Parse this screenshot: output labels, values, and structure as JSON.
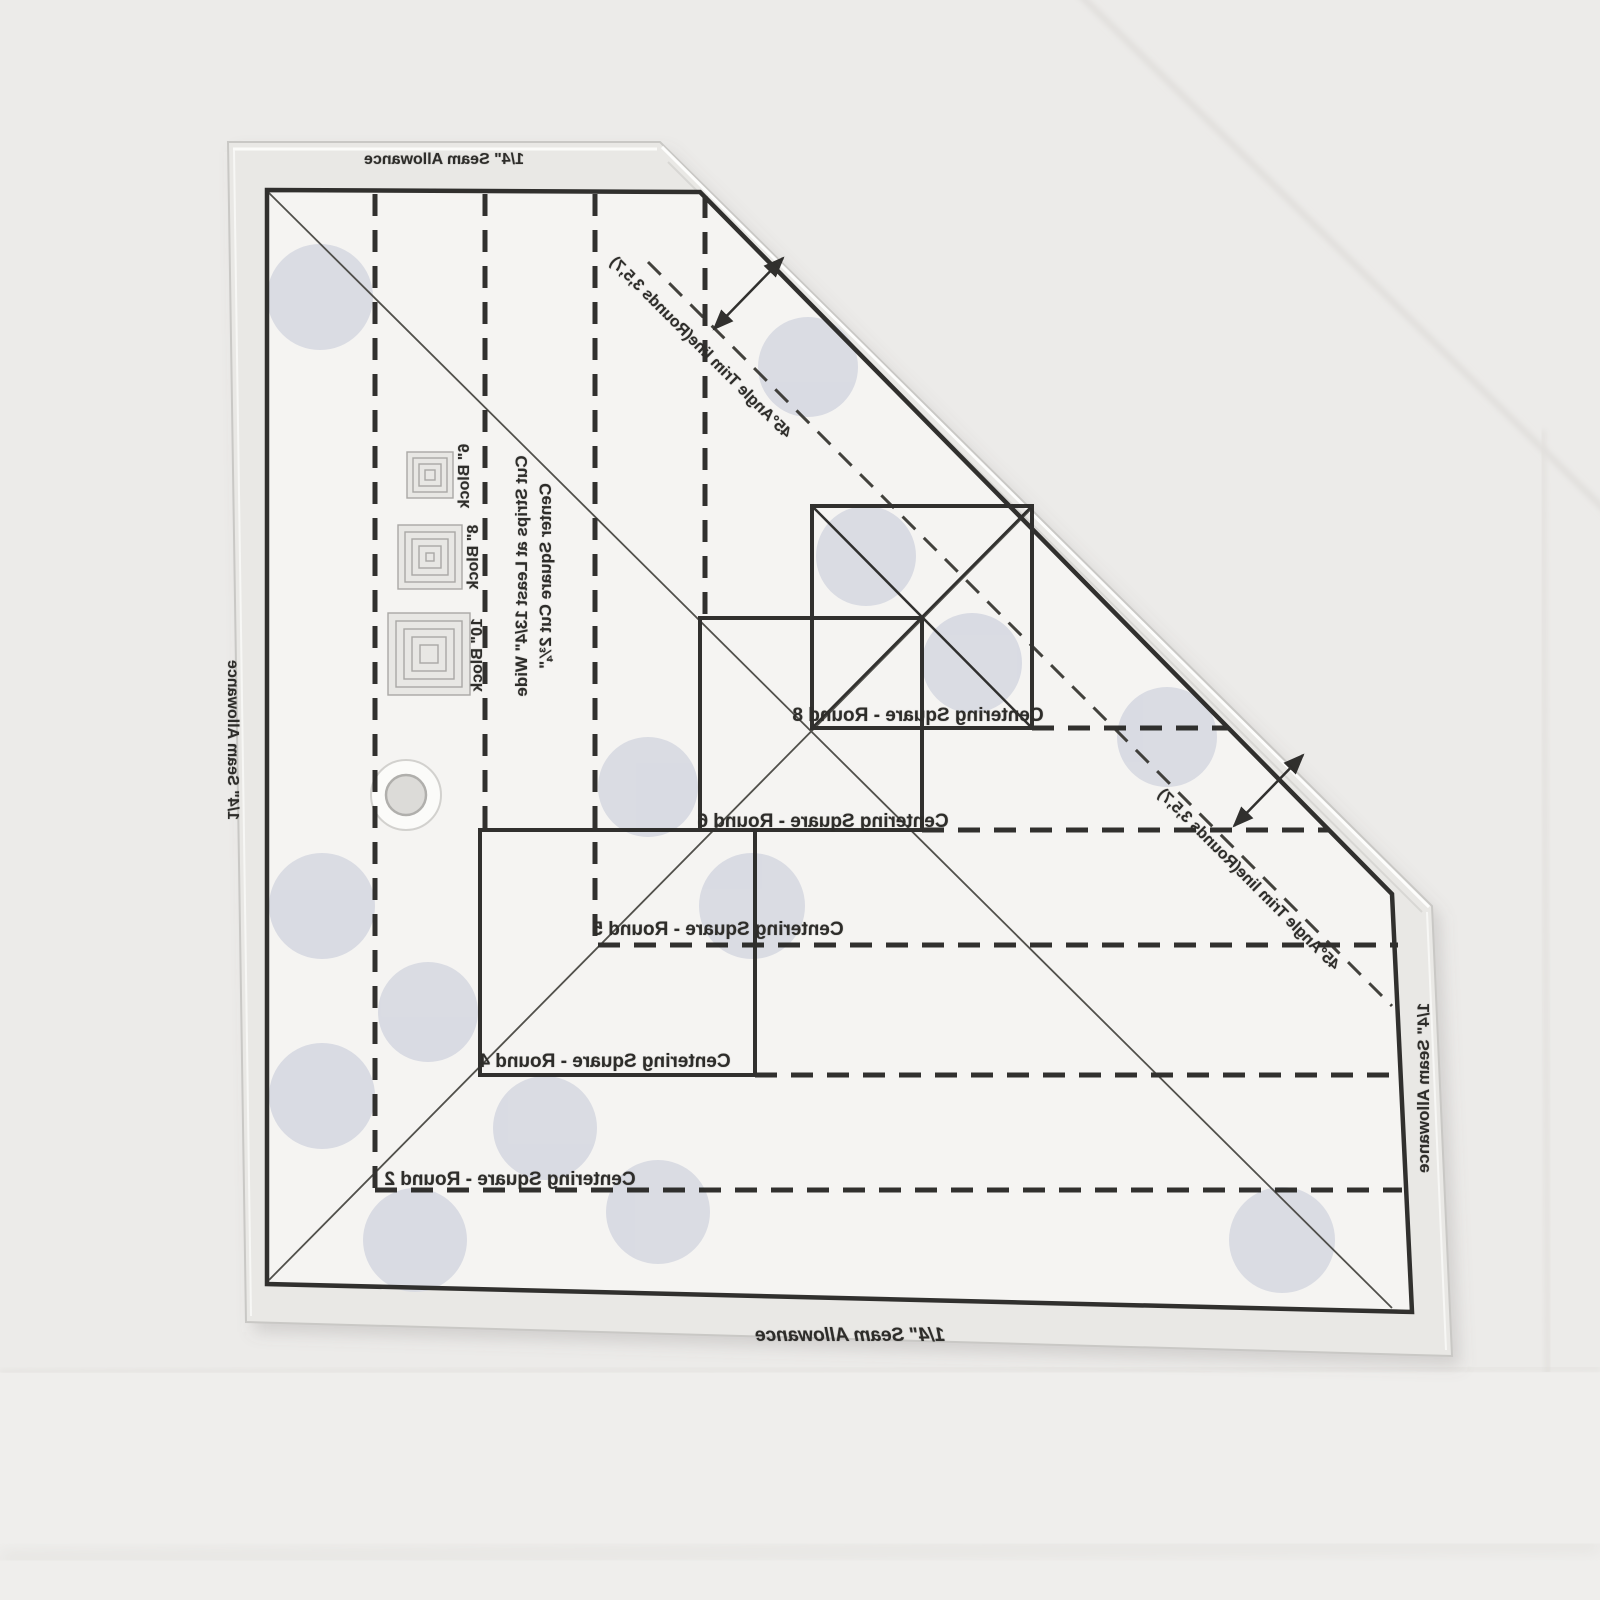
{
  "ruler": {
    "type_note": "transparent log cabin quilting trim ruler, photographed face-down (printing mirrored)",
    "seam_allowance": {
      "top": "1/4\" Seam Allowance",
      "left": "1/4\" Seam Allowance",
      "right": "1/4\" Seam Allowance",
      "bottom": "1/4\" Seam Allowance"
    },
    "angle_trim": {
      "upper": "45°Angle Trim line(Rounds 3,5,7)",
      "lower": "45°Angle Trim line(Rounds 3,5,7)"
    },
    "instructions": {
      "strips": "Cut Strips at Least 13/4\" Wide",
      "center_square": "Center Square Cut 2¾\""
    },
    "block_sizes": [
      {
        "label": "6\" Block"
      },
      {
        "label": "8\" Block"
      },
      {
        "label": "10\" Block"
      }
    ],
    "centering_squares": [
      {
        "label": "Centering Square - Round 8"
      },
      {
        "label": "Centering Square - Round 6"
      },
      {
        "label": "Centering Square - Round 5"
      },
      {
        "label": "Centering Square - Round 4"
      },
      {
        "label": "Centering Square - Round 2"
      }
    ],
    "colors": {
      "print": "#2e2d2a",
      "grip_dot": "#d7d9e2",
      "acrylic_edge": "#c9c8c5",
      "paper_background": "#ecebe9"
    }
  }
}
